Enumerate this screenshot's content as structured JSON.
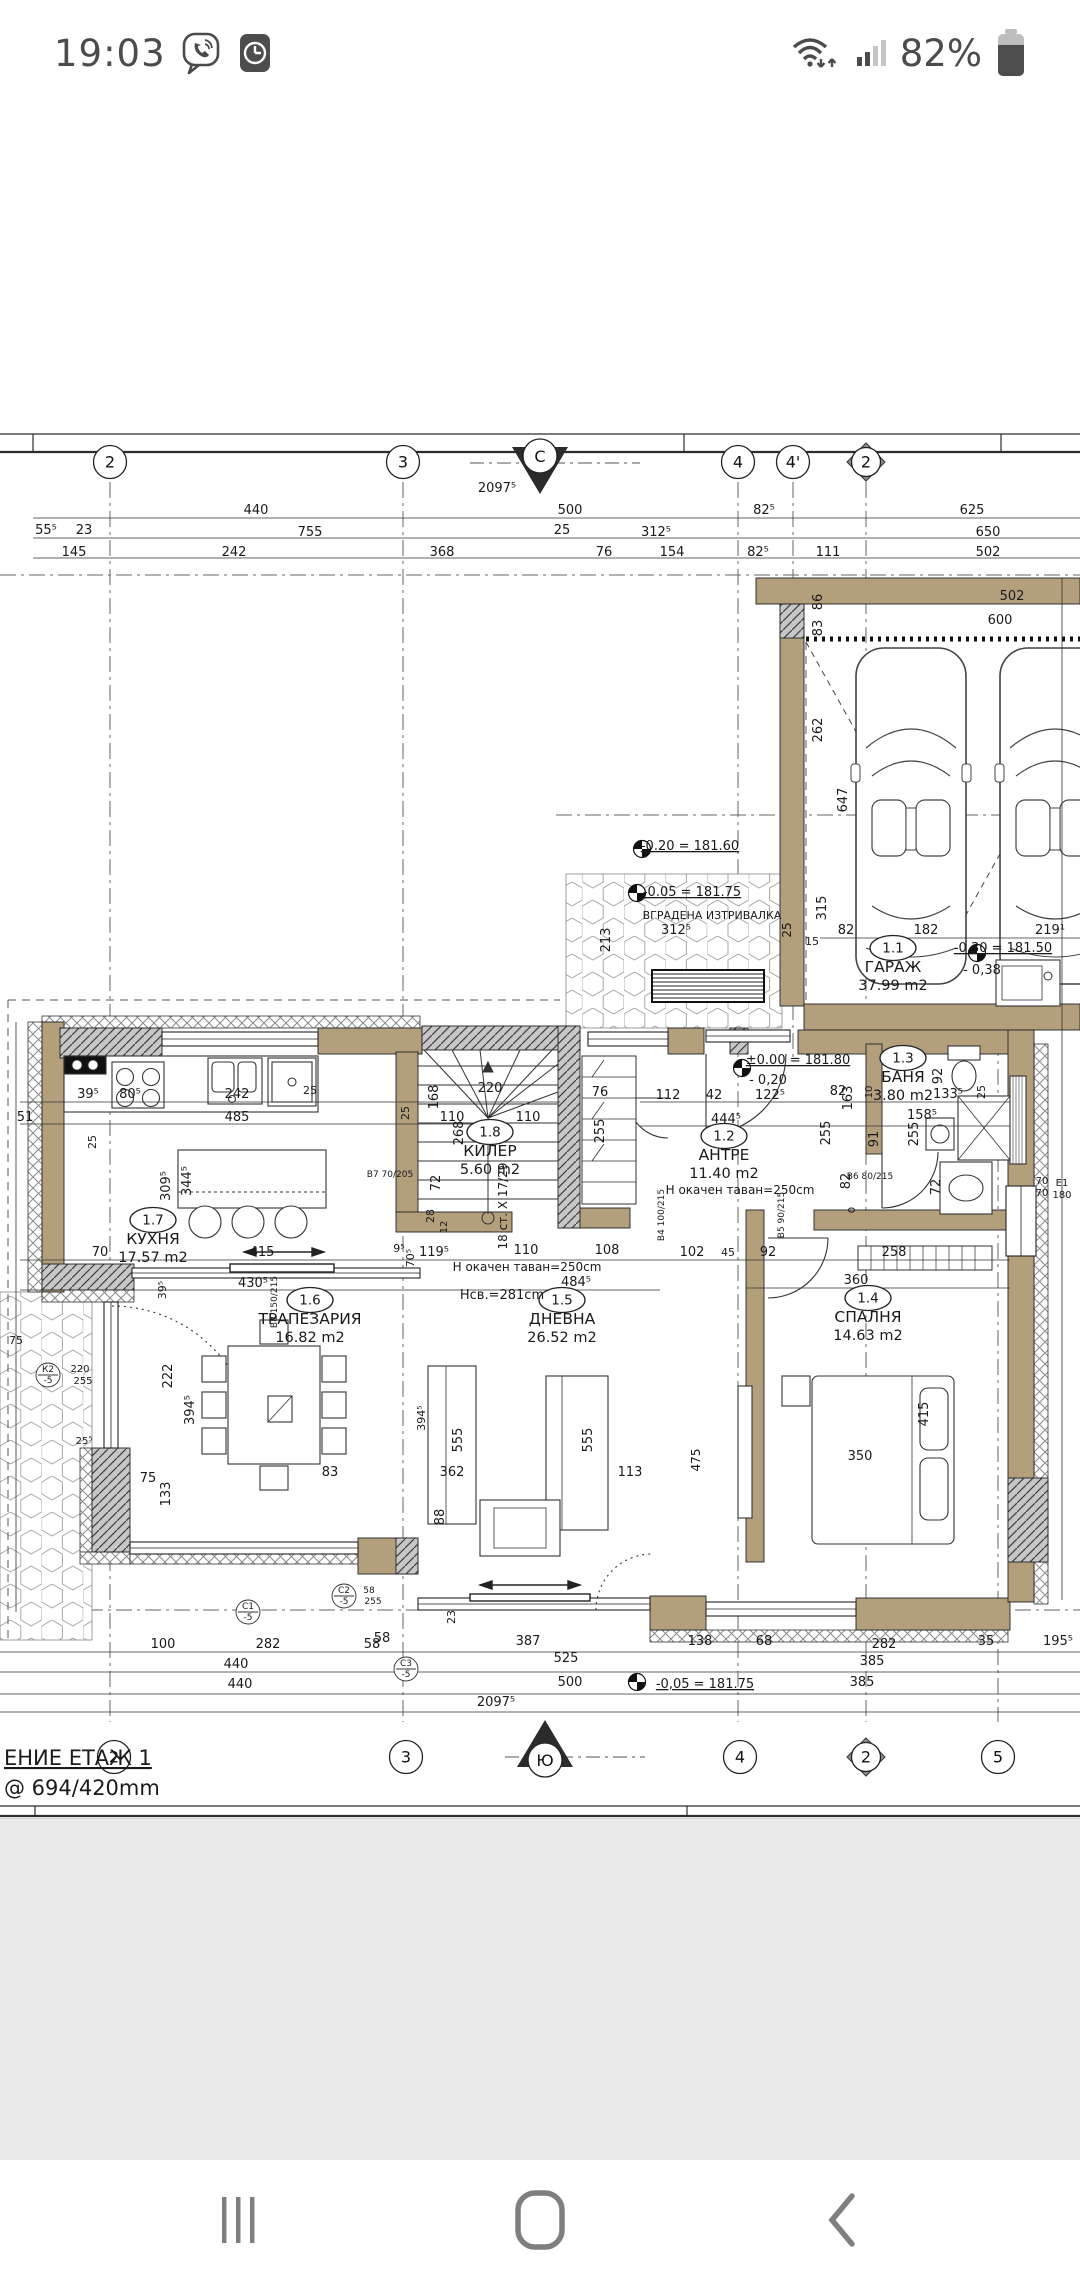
{
  "status_bar": {
    "time": "19:03",
    "battery_pct": "82%",
    "icons": [
      "viber-icon",
      "clock-app-icon",
      "wifi-icon",
      "signal-icon",
      "battery-icon"
    ]
  },
  "nav_bar": {
    "buttons": [
      "recents",
      "home",
      "back"
    ]
  },
  "sheet": {
    "title_fragment": "ЕНИЕ ЕТАЖ 1",
    "scale_note": "@ 694/420mm"
  },
  "plan": {
    "compass": {
      "north": "С",
      "south": "Ю"
    },
    "grid_top": [
      {
        "l": "2",
        "x": 110,
        "shape": "circle"
      },
      {
        "l": "3",
        "x": 403,
        "shape": "circle"
      },
      {
        "l": "4",
        "x": 738,
        "shape": "circle"
      },
      {
        "l": "4'",
        "x": 793,
        "shape": "circle"
      },
      {
        "l": "2",
        "x": 866,
        "shape": "diamond"
      }
    ],
    "grid_bottom": [
      {
        "l": "2",
        "x": 114,
        "shape": "circle"
      },
      {
        "l": "3",
        "x": 406,
        "shape": "circle"
      },
      {
        "l": "4",
        "x": 740,
        "shape": "circle"
      },
      {
        "l": "2",
        "x": 866,
        "shape": "diamond"
      },
      {
        "l": "5",
        "x": 998,
        "shape": "circle"
      }
    ],
    "rooms": [
      {
        "tag": "1.1",
        "name": "ГАРАЖ",
        "area": "37.99 m2",
        "x": 893,
        "y": 948
      },
      {
        "tag": "1.2",
        "name": "АНТРЕ",
        "area": "11.40 m2",
        "x": 724,
        "y": 1136
      },
      {
        "tag": "1.3",
        "name": "БАНЯ",
        "area": "3.80 m2",
        "x": 903,
        "y": 1058
      },
      {
        "tag": "1.4",
        "name": "СПАЛНЯ",
        "area": "14.63 m2",
        "x": 868,
        "y": 1298
      },
      {
        "tag": "1.5",
        "name": "ДНЕВНА",
        "area": "26.52 m2",
        "x": 562,
        "y": 1300
      },
      {
        "tag": "1.6",
        "name": "ТРАПЕЗАРИЯ",
        "area": "16.82 m2",
        "x": 310,
        "y": 1300
      },
      {
        "tag": "1.7",
        "name": "КУХНЯ",
        "area": "17.57 m2",
        "x": 153,
        "y": 1220
      },
      {
        "tag": "1.8",
        "name": "КИЛЕР",
        "area": "5.60 m2",
        "x": 490,
        "y": 1132
      }
    ],
    "level_markers": [
      {
        "x": 642,
        "y": 849
      },
      {
        "x": 637,
        "y": 893
      },
      {
        "x": 742,
        "y": 1068
      },
      {
        "x": 977,
        "y": 953
      },
      {
        "x": 637,
        "y": 1682
      }
    ],
    "labels": [
      {
        "t": "2097⁵",
        "x": 497,
        "y": 492
      },
      {
        "t": "440",
        "x": 256,
        "y": 514
      },
      {
        "t": "500",
        "x": 570,
        "y": 514
      },
      {
        "t": "82⁵",
        "x": 764,
        "y": 514
      },
      {
        "t": "625",
        "x": 972,
        "y": 514
      },
      {
        "t": "55⁵",
        "x": 46,
        "y": 534
      },
      {
        "t": "23",
        "x": 84,
        "y": 534
      },
      {
        "t": "755",
        "x": 310,
        "y": 536
      },
      {
        "t": "25",
        "x": 562,
        "y": 534
      },
      {
        "t": "312⁵",
        "x": 656,
        "y": 536
      },
      {
        "t": "650",
        "x": 988,
        "y": 536
      },
      {
        "t": "145",
        "x": 74,
        "y": 556
      },
      {
        "t": "242",
        "x": 234,
        "y": 556
      },
      {
        "t": "368",
        "x": 442,
        "y": 556
      },
      {
        "t": "76",
        "x": 604,
        "y": 556
      },
      {
        "t": "154",
        "x": 672,
        "y": 556
      },
      {
        "t": "82⁵",
        "x": 758,
        "y": 556
      },
      {
        "t": "111",
        "x": 828,
        "y": 556
      },
      {
        "t": "502",
        "x": 988,
        "y": 556
      },
      {
        "t": "502",
        "x": 1012,
        "y": 600
      },
      {
        "t": "600",
        "x": 1000,
        "y": 624
      },
      {
        "t": "86",
        "x": 822,
        "y": 602,
        "r": -90
      },
      {
        "t": "83",
        "x": 822,
        "y": 628,
        "r": -90
      },
      {
        "t": "262",
        "x": 822,
        "y": 730,
        "r": -90
      },
      {
        "t": "647",
        "x": 847,
        "y": 800,
        "r": -90
      },
      {
        "t": "315",
        "x": 826,
        "y": 908,
        "r": -90
      },
      {
        "t": "82",
        "x": 846,
        "y": 934
      },
      {
        "t": "182",
        "x": 926,
        "y": 934
      },
      {
        "t": "219¹",
        "x": 1050,
        "y": 934
      },
      {
        "t": "-0.30 = 181.50",
        "x": 1003,
        "y": 952,
        "u": 1
      },
      {
        "t": "- 0,38",
        "x": 982,
        "y": 974
      },
      {
        "t": "-0.20 = 181.60",
        "x": 690,
        "y": 850,
        "u": 1
      },
      {
        "t": "-0.05 = 181.75",
        "x": 692,
        "y": 896,
        "u": 1
      },
      {
        "t": "ВГРАДЕНА ИЗТРИВАЛКА",
        "x": 712,
        "y": 919,
        "s": 11
      },
      {
        "t": "312⁵",
        "x": 676,
        "y": 934
      },
      {
        "t": "213",
        "x": 610,
        "y": 940,
        "r": -90
      },
      {
        "t": "25",
        "x": 791,
        "y": 930,
        "r": -90,
        "s": 12
      },
      {
        "t": "15",
        "x": 812,
        "y": 945,
        "s": 11
      },
      {
        "t": "±0.00 = 181.80",
        "x": 798,
        "y": 1064,
        "u": 1
      },
      {
        "t": "- 0,20",
        "x": 768,
        "y": 1084
      },
      {
        "t": "39⁵",
        "x": 88,
        "y": 1098
      },
      {
        "t": "80⁵",
        "x": 130,
        "y": 1098
      },
      {
        "t": "242",
        "x": 237,
        "y": 1098
      },
      {
        "t": "25",
        "x": 310,
        "y": 1094,
        "s": 11
      },
      {
        "t": "485",
        "x": 237,
        "y": 1121
      },
      {
        "t": "51",
        "x": 25,
        "y": 1121
      },
      {
        "t": "309⁵",
        "x": 170,
        "y": 1186,
        "r": -90
      },
      {
        "t": "344⁵",
        "x": 191,
        "y": 1181,
        "r": -90
      },
      {
        "t": "220",
        "x": 490,
        "y": 1092
      },
      {
        "t": "168",
        "x": 438,
        "y": 1097,
        "r": -90
      },
      {
        "t": "110",
        "x": 452,
        "y": 1121
      },
      {
        "t": "110",
        "x": 528,
        "y": 1121
      },
      {
        "t": "268",
        "x": 463,
        "y": 1133,
        "r": -90
      },
      {
        "t": "25",
        "x": 409,
        "y": 1113,
        "r": -90,
        "s": 11
      },
      {
        "t": "72",
        "x": 440,
        "y": 1183,
        "r": -90
      },
      {
        "t": "28",
        "x": 434,
        "y": 1216,
        "r": -90,
        "s": 11
      },
      {
        "t": "12",
        "x": 447,
        "y": 1227,
        "r": -90,
        "s": 10
      },
      {
        "t": "18 ст. X 17/29",
        "x": 507,
        "y": 1206,
        "r": -90,
        "s": 12
      },
      {
        "t": "76",
        "x": 600,
        "y": 1096
      },
      {
        "t": "255",
        "x": 604,
        "y": 1131,
        "r": -90
      },
      {
        "t": "112",
        "x": 668,
        "y": 1099
      },
      {
        "t": "42",
        "x": 714,
        "y": 1099
      },
      {
        "t": "122⁵",
        "x": 770,
        "y": 1099
      },
      {
        "t": "444⁵",
        "x": 726,
        "y": 1123
      },
      {
        "t": "82",
        "x": 838,
        "y": 1095
      },
      {
        "t": "163",
        "x": 852,
        "y": 1098,
        "r": -90
      },
      {
        "t": "255",
        "x": 830,
        "y": 1133,
        "r": -90
      },
      {
        "t": "10",
        "x": 872,
        "y": 1092,
        "r": -90,
        "s": 10
      },
      {
        "t": "92",
        "x": 942,
        "y": 1076,
        "r": -90
      },
      {
        "t": "133⁵",
        "x": 948,
        "y": 1098
      },
      {
        "t": "25",
        "x": 985,
        "y": 1092,
        "r": -90,
        "s": 11
      },
      {
        "t": "158⁵",
        "x": 922,
        "y": 1119
      },
      {
        "t": "255",
        "x": 918,
        "y": 1134,
        "r": -90
      },
      {
        "t": "91",
        "x": 878,
        "y": 1139,
        "r": -90
      },
      {
        "t": "72",
        "x": 940,
        "y": 1187,
        "r": -90
      },
      {
        "t": "82",
        "x": 850,
        "y": 1181,
        "r": -90
      },
      {
        "t": "0",
        "x": 855,
        "y": 1210,
        "r": -90,
        "s": 10
      },
      {
        "t": "В6 80/215",
        "x": 870,
        "y": 1179,
        "s": 9
      },
      {
        "t": "В4 100/215",
        "x": 664,
        "y": 1215,
        "r": -90,
        "s": 9
      },
      {
        "t": "В5 90/215",
        "x": 784,
        "y": 1215,
        "r": -90,
        "s": 9
      },
      {
        "t": "70",
        "x": 1042,
        "y": 1184,
        "s": 10
      },
      {
        "t": "70",
        "x": 1042,
        "y": 1196,
        "s": 10
      },
      {
        "t": "Е1",
        "x": 1062,
        "y": 1186,
        "s": 10
      },
      {
        "t": "180",
        "x": 1062,
        "y": 1198,
        "s": 10
      },
      {
        "t": "Н окачен таван=250cm",
        "x": 740,
        "y": 1194,
        "s": 12
      },
      {
        "t": "Н окачен таван=250cm",
        "x": 527,
        "y": 1271,
        "s": 12
      },
      {
        "t": "Нсв.=281cm",
        "x": 502,
        "y": 1299,
        "s": 13
      },
      {
        "t": "119⁵",
        "x": 434,
        "y": 1256
      },
      {
        "t": "70⁵",
        "x": 414,
        "y": 1258,
        "r": -90,
        "s": 11
      },
      {
        "t": "9⁵",
        "x": 399,
        "y": 1252,
        "s": 11
      },
      {
        "t": "110",
        "x": 526,
        "y": 1254
      },
      {
        "t": "108",
        "x": 607,
        "y": 1254
      },
      {
        "t": "102",
        "x": 692,
        "y": 1256
      },
      {
        "t": "45",
        "x": 728,
        "y": 1256,
        "s": 11
      },
      {
        "t": "92",
        "x": 768,
        "y": 1256
      },
      {
        "t": "258",
        "x": 894,
        "y": 1256
      },
      {
        "t": "484⁵",
        "x": 576,
        "y": 1286
      },
      {
        "t": "360",
        "x": 856,
        "y": 1284
      },
      {
        "t": "70",
        "x": 100,
        "y": 1256
      },
      {
        "t": "415",
        "x": 262,
        "y": 1256
      },
      {
        "t": "430⁵",
        "x": 253,
        "y": 1287
      },
      {
        "t": "39⁵",
        "x": 166,
        "y": 1290,
        "r": -90,
        "s": 11
      },
      {
        "t": "25",
        "x": 96,
        "y": 1142,
        "r": -90,
        "s": 11
      },
      {
        "t": "222",
        "x": 172,
        "y": 1376,
        "r": -90
      },
      {
        "t": "394⁵",
        "x": 194,
        "y": 1410,
        "r": -90
      },
      {
        "t": "75",
        "x": 148,
        "y": 1482
      },
      {
        "t": "133",
        "x": 170,
        "y": 1494,
        "r": -90
      },
      {
        "t": "75",
        "x": 16,
        "y": 1344,
        "s": 11
      },
      {
        "t": "К2",
        "x": 48,
        "y": 1372,
        "s": 9
      },
      {
        "t": "-5",
        "x": 48,
        "y": 1383,
        "s": 9
      },
      {
        "t": "220",
        "x": 80,
        "y": 1372,
        "s": 10
      },
      {
        "t": "255",
        "x": 83,
        "y": 1384,
        "s": 10
      },
      {
        "t": "25⁵",
        "x": 84,
        "y": 1444,
        "s": 10
      },
      {
        "t": "555",
        "x": 462,
        "y": 1440,
        "r": -90
      },
      {
        "t": "555",
        "x": 592,
        "y": 1440,
        "r": -90
      },
      {
        "t": "394⁵",
        "x": 425,
        "y": 1418,
        "r": -90,
        "s": 11
      },
      {
        "t": "475",
        "x": 700,
        "y": 1460,
        "r": -90,
        "s": 12
      },
      {
        "t": "415",
        "x": 928,
        "y": 1414,
        "r": -90
      },
      {
        "t": "350",
        "x": 860,
        "y": 1460
      },
      {
        "t": "362",
        "x": 452,
        "y": 1476
      },
      {
        "t": "113",
        "x": 630,
        "y": 1476
      },
      {
        "t": "83",
        "x": 330,
        "y": 1476
      },
      {
        "t": "88",
        "x": 444,
        "y": 1517,
        "r": -90
      },
      {
        "t": "23",
        "x": 455,
        "y": 1617,
        "r": -90,
        "s": 11
      },
      {
        "t": "58",
        "x": 382,
        "y": 1642
      },
      {
        "t": "С2",
        "x": 344,
        "y": 1593,
        "s": 9
      },
      {
        "t": "-5",
        "x": 344,
        "y": 1604,
        "s": 9
      },
      {
        "t": "58",
        "x": 369,
        "y": 1593,
        "s": 9
      },
      {
        "t": "255",
        "x": 373,
        "y": 1604,
        "s": 9
      },
      {
        "t": "С1",
        "x": 248,
        "y": 1609,
        "s": 9
      },
      {
        "t": "-5",
        "x": 248,
        "y": 1620,
        "s": 9
      },
      {
        "t": "С3",
        "x": 406,
        "y": 1666,
        "s": 9
      },
      {
        "t": "-5",
        "x": 406,
        "y": 1677,
        "s": 9
      },
      {
        "t": "В7 70/205",
        "x": 390,
        "y": 1177,
        "s": 9
      },
      {
        "t": "В8 150/215",
        "x": 277,
        "y": 1302,
        "r": -90,
        "s": 9
      },
      {
        "t": "100",
        "x": 163,
        "y": 1648
      },
      {
        "t": "282",
        "x": 268,
        "y": 1648
      },
      {
        "t": "58",
        "x": 372,
        "y": 1648
      },
      {
        "t": "387",
        "x": 528,
        "y": 1645
      },
      {
        "t": "138",
        "x": 700,
        "y": 1645
      },
      {
        "t": "68",
        "x": 764,
        "y": 1645
      },
      {
        "t": "282",
        "x": 884,
        "y": 1648
      },
      {
        "t": "35",
        "x": 986,
        "y": 1645
      },
      {
        "t": "195⁵",
        "x": 1058,
        "y": 1645
      },
      {
        "t": "440",
        "x": 236,
        "y": 1668
      },
      {
        "t": "525",
        "x": 566,
        "y": 1662
      },
      {
        "t": "385",
        "x": 872,
        "y": 1665
      },
      {
        "t": "440",
        "x": 240,
        "y": 1688
      },
      {
        "t": "500",
        "x": 570,
        "y": 1686
      },
      {
        "t": "-0,05 = 181.75",
        "x": 705,
        "y": 1688,
        "u": 1
      },
      {
        "t": "385",
        "x": 862,
        "y": 1686
      },
      {
        "t": "2097⁵",
        "x": 496,
        "y": 1706
      },
      {
        "t": "ЕНИЕ ЕТАЖ 1",
        "x": 4,
        "y": 1765,
        "s": 21,
        "a": "start",
        "u": 1
      },
      {
        "t": "@ 694/420mm",
        "x": 4,
        "y": 1795,
        "s": 21,
        "a": "start"
      }
    ]
  }
}
